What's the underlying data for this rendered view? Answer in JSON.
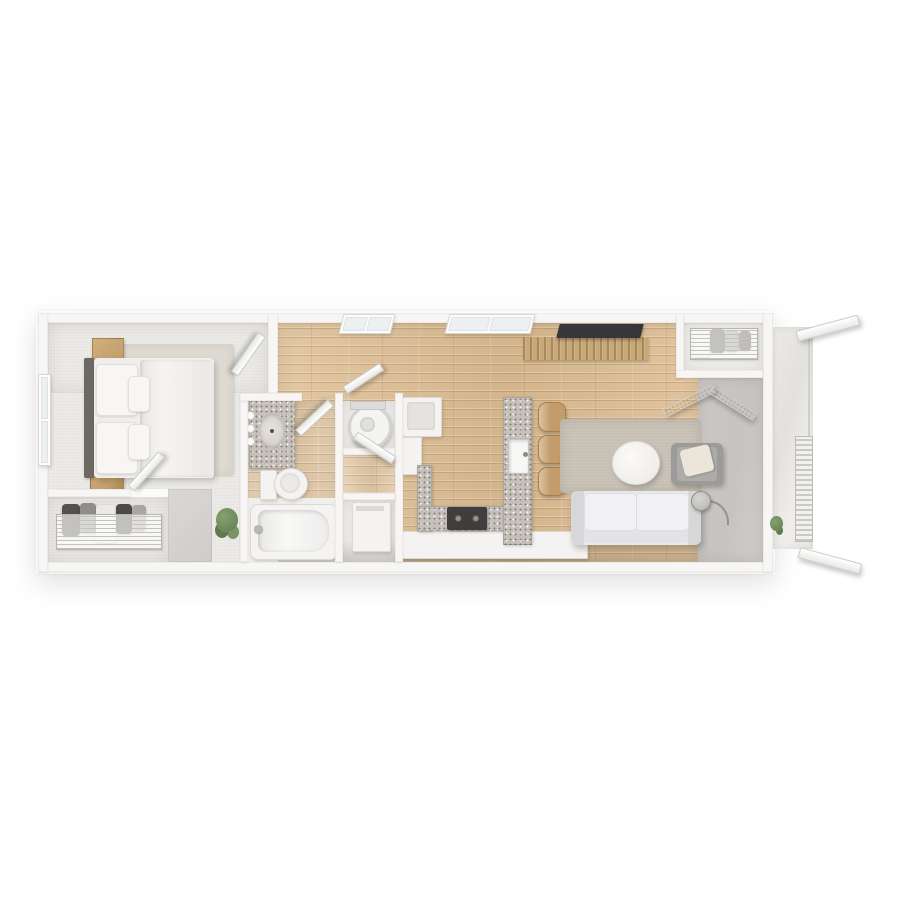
{
  "scene": {
    "type": "3d-floor-plan-render",
    "view": "top-down",
    "description": "One-bedroom apartment with balcony, rendered in 3D and centered on a white background",
    "rooms": [
      "bedroom",
      "bedroom-closet",
      "hallway",
      "bathroom",
      "laundry-closet",
      "utility-closet",
      "kitchen",
      "living-room",
      "entry",
      "coat-closet",
      "balcony"
    ]
  },
  "colors": {
    "bg": "#ffffff",
    "wall": "#f7f6f4",
    "wallBlock": "#cfcdcb",
    "carpet": "#edebe7",
    "rugBedroom": "#dfdad1",
    "rugLiving": "#c7c0b5",
    "wood": "#ddbd92",
    "pale": "#f0efec",
    "granite": "#c6c0ba",
    "appliance": "#f4f3f1",
    "headboard": "#6e6862",
    "duvet": "#f6f5f3",
    "nightstand": "#c3a06c",
    "tv": "#37373a",
    "console": "#c9a878",
    "sofa": "#e9e9eb",
    "armchair": "#9d9b98",
    "pillowCream": "#ebe6d9",
    "entryConcrete": "#c6c3c0",
    "balcony": "#e8e7e3",
    "plant": "#6e8a5a",
    "stool": "#c49c6b",
    "stove": "#3f3e3c",
    "clothesDark": "#53514e",
    "clothesGray": "#908e8b",
    "clothesLight": "#eceae6"
  }
}
